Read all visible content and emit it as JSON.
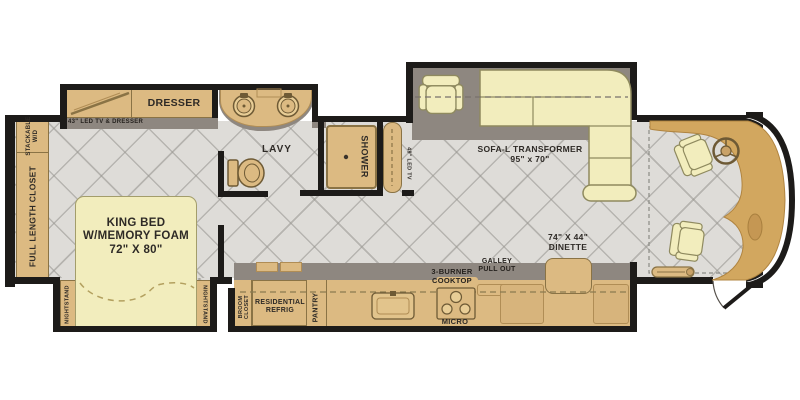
{
  "labels": {
    "stackable_wd": "STACKABLE\nW/D",
    "full_length_closet": "FULL LENGTH CLOSET",
    "dresser": "DRESSER",
    "tv_dresser_shelf": "43\" LED TV & DRESSER",
    "king_bed": "KING BED\nW/MEMORY FOAM\n72\" X 80\"",
    "nightstand_left": "NIGHTSTAND",
    "nightstand_right": "NIGHTSTAND",
    "lavy": "LAVY",
    "shower": "SHOWER",
    "led_tv": "49\" LED TV",
    "sofa": "SOFA-L TRANSFORMER\n95\" x 70\"",
    "dinette": "74\" X 44\"\nDINETTE",
    "galley_pull_out": "GALLEY\nPULL OUT",
    "cooktop": "3-BURNER\nCOOKTOP",
    "micro": "MICRO",
    "pantry": "PANTRY",
    "refrigerator": "RESIDENTIAL\nREFRIG",
    "broom_closet": "BROOM\nCLOSET"
  },
  "palette": {
    "wall": "#1d1b19",
    "floor": "#dedcd8",
    "tile_line": "#96948e",
    "cabinet_tan": "#dcba82",
    "cabinet_border": "#8a7345",
    "upholstery": "#f2edbd",
    "upholstery_border": "#8f8a5f",
    "slide_band_gray": "#8e8780",
    "dash_tan": "#d2a75f",
    "text": "#2e2a26"
  }
}
